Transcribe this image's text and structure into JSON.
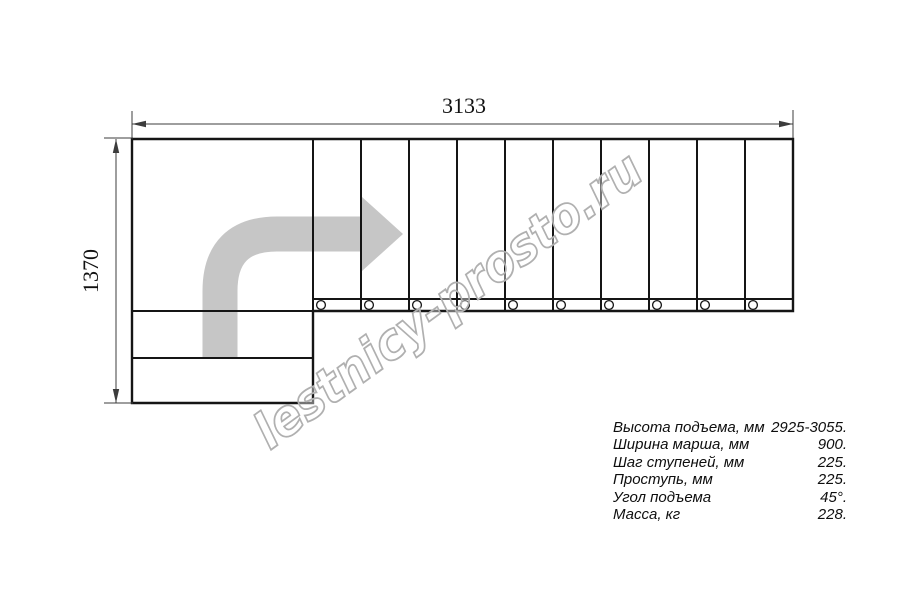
{
  "watermark": {
    "text": "lestnicy-prosto.ru"
  },
  "dimensions": {
    "width": {
      "value": "3133"
    },
    "height": {
      "value": "1370"
    }
  },
  "specs": [
    {
      "label": "Высота подъема, мм",
      "value": "2925-3055."
    },
    {
      "label": "Ширина марша, мм",
      "value": "900."
    },
    {
      "label": "Шаг ступеней, мм",
      "value": "225."
    },
    {
      "label": "Проступь, мм",
      "value": "225."
    },
    {
      "label": "Угол подъема",
      "value": "45°."
    },
    {
      "label": "Масса, кг",
      "value": "228."
    }
  ],
  "drawing": {
    "flight": {
      "x_start": 313,
      "x_end": 793,
      "y_top": 139,
      "y_bottom": 311,
      "treads": 10,
      "band_y": 299,
      "circle_cy": 305,
      "circle_r": 4.4,
      "circle_dx": 8
    },
    "colors": {
      "line": "#151515",
      "dimension": "#3c3c3c",
      "arrow_fill": "#c6c6c6",
      "watermark": "#b0b0b0"
    }
  }
}
